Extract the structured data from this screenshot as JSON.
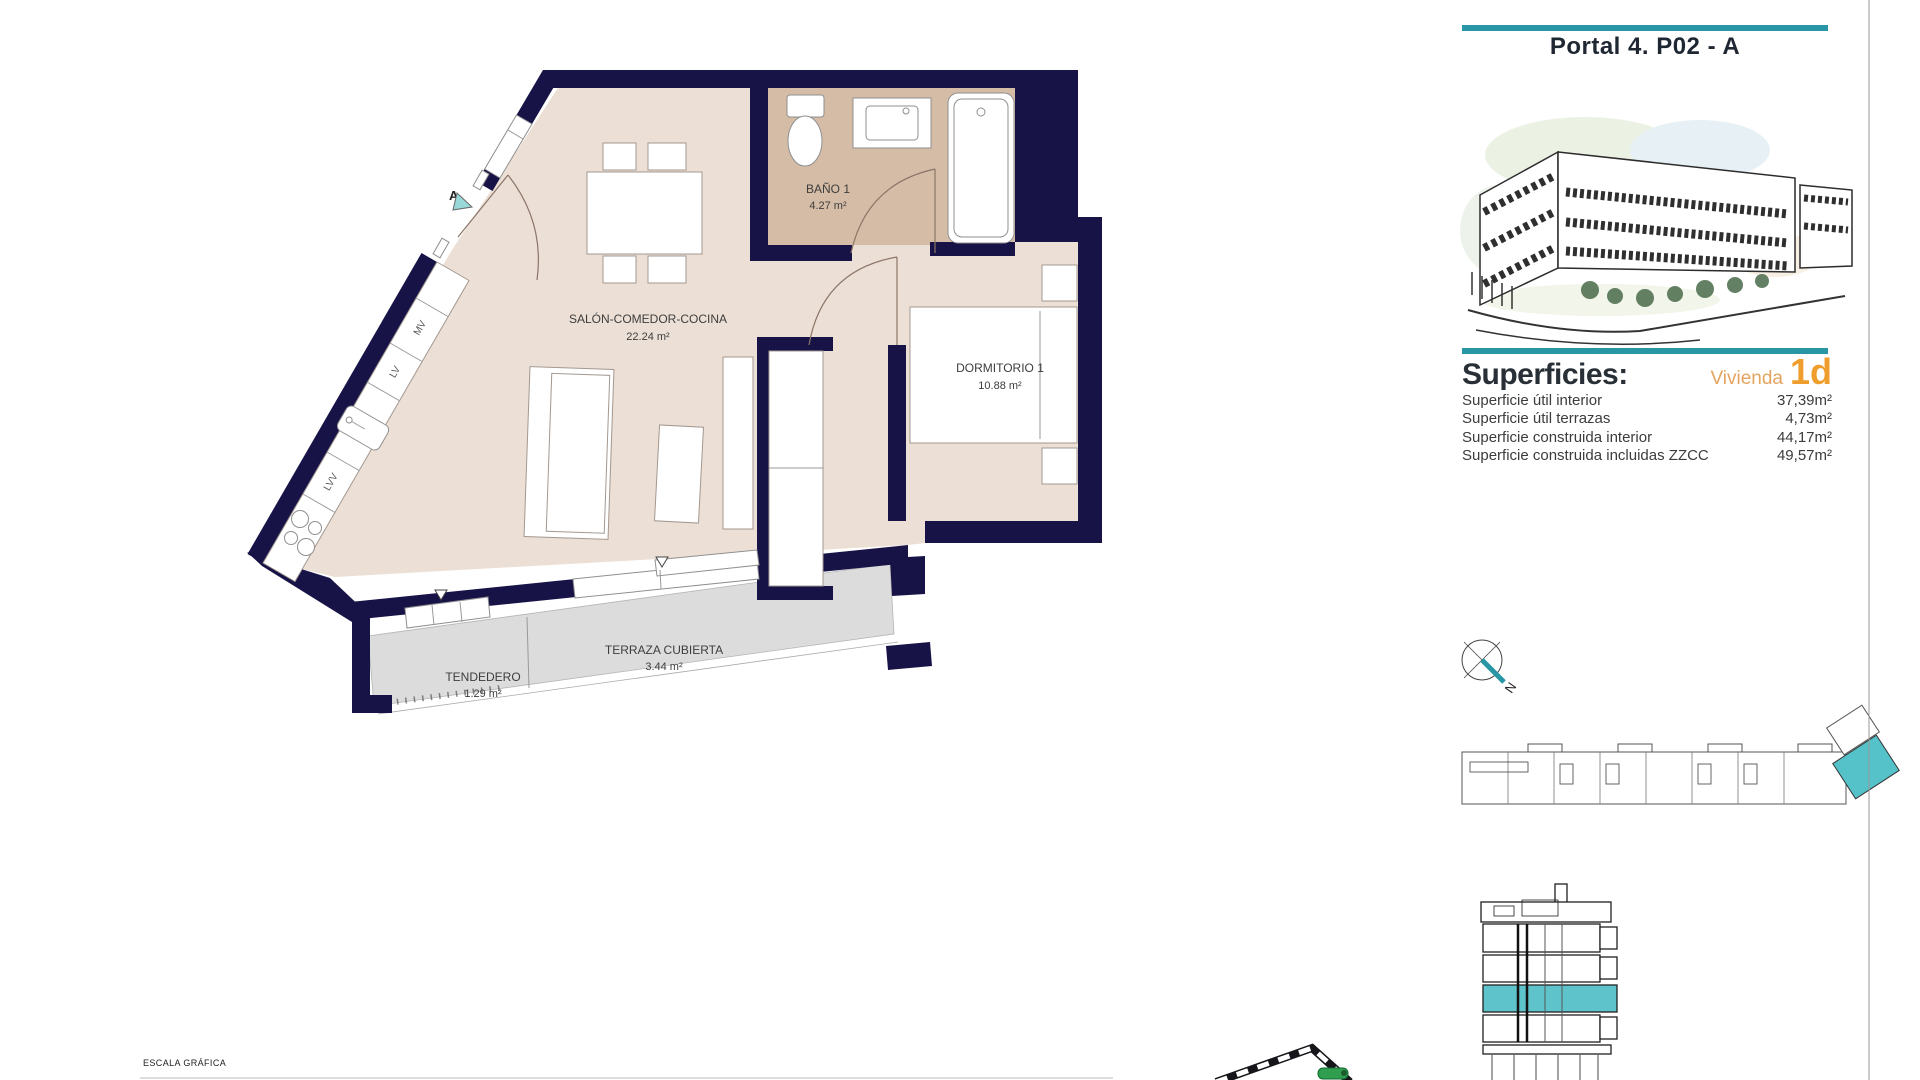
{
  "page": {
    "title": "Portal 4. P02 - A",
    "scale_label": "ESCALA GRÁFICA"
  },
  "superficies": {
    "heading": "Superficies:",
    "vivienda_label": "Vivienda",
    "vivienda_value": "1d",
    "rows": [
      {
        "label": "Superficie útil interior",
        "value": "37,39m²"
      },
      {
        "label": "Superficie útil terrazas",
        "value": "4,73m²"
      },
      {
        "label": "Superficie construida interior",
        "value": "44,17m²"
      },
      {
        "label": "Superficie construida incluidas ZZCC",
        "value": "49,57m²"
      }
    ]
  },
  "floorplan": {
    "rooms": [
      {
        "name": "SALÓN-COMEDOR-COCINA",
        "area": "22.24 m²"
      },
      {
        "name": "BAÑO 1",
        "area": "4.27 m²"
      },
      {
        "name": "DORMITORIO 1",
        "area": "10.88 m²"
      },
      {
        "name": "TERRAZA CUBIERTA",
        "area": "3.44 m²"
      },
      {
        "name": "TENDEDERO",
        "area": "1.29 m²"
      }
    ],
    "kitchen_labels": [
      "MV",
      "LV",
      "LVV"
    ],
    "entry_marker": "A",
    "compass_label": "N"
  },
  "colors": {
    "accent_teal": "#2996a5",
    "wall_navy": "#171347",
    "floor_beige": "#ecdfd5",
    "bath_tan": "#d5bca6",
    "terrace_gray": "#dcdcdc",
    "highlight_teal": "#5ec3ca",
    "orange": "#ef9d2c",
    "orange_light": "#e4a45f",
    "green_marker": "#2f9e4f"
  }
}
